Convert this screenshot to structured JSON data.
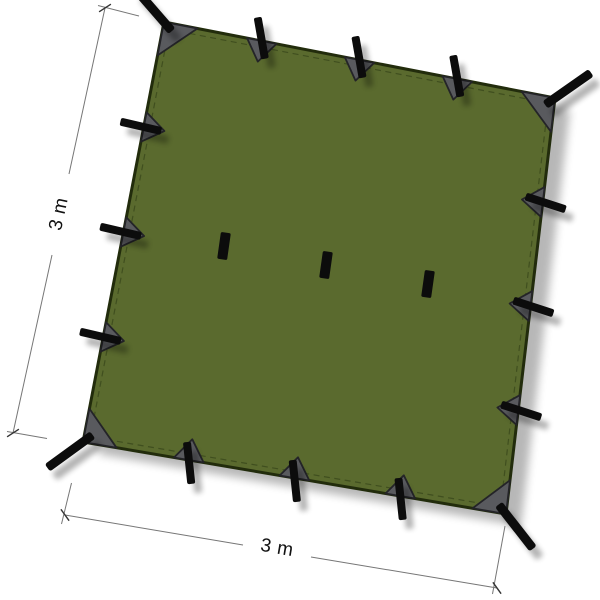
{
  "annotations": {
    "height_label": "3 m",
    "width_label": "3 m"
  },
  "colors": {
    "background": "#ffffff",
    "tarp_fill": "#5a6a2e",
    "tarp_edge": "#222c0c",
    "stitch": "#3c4a1c",
    "patch_fill": "#595a5e",
    "patch_edge": "#242428",
    "strap_fill": "#0c0c0c",
    "dimension_line": "#767676",
    "dimension_tick": "#333333",
    "label_color": "#111111"
  }
}
